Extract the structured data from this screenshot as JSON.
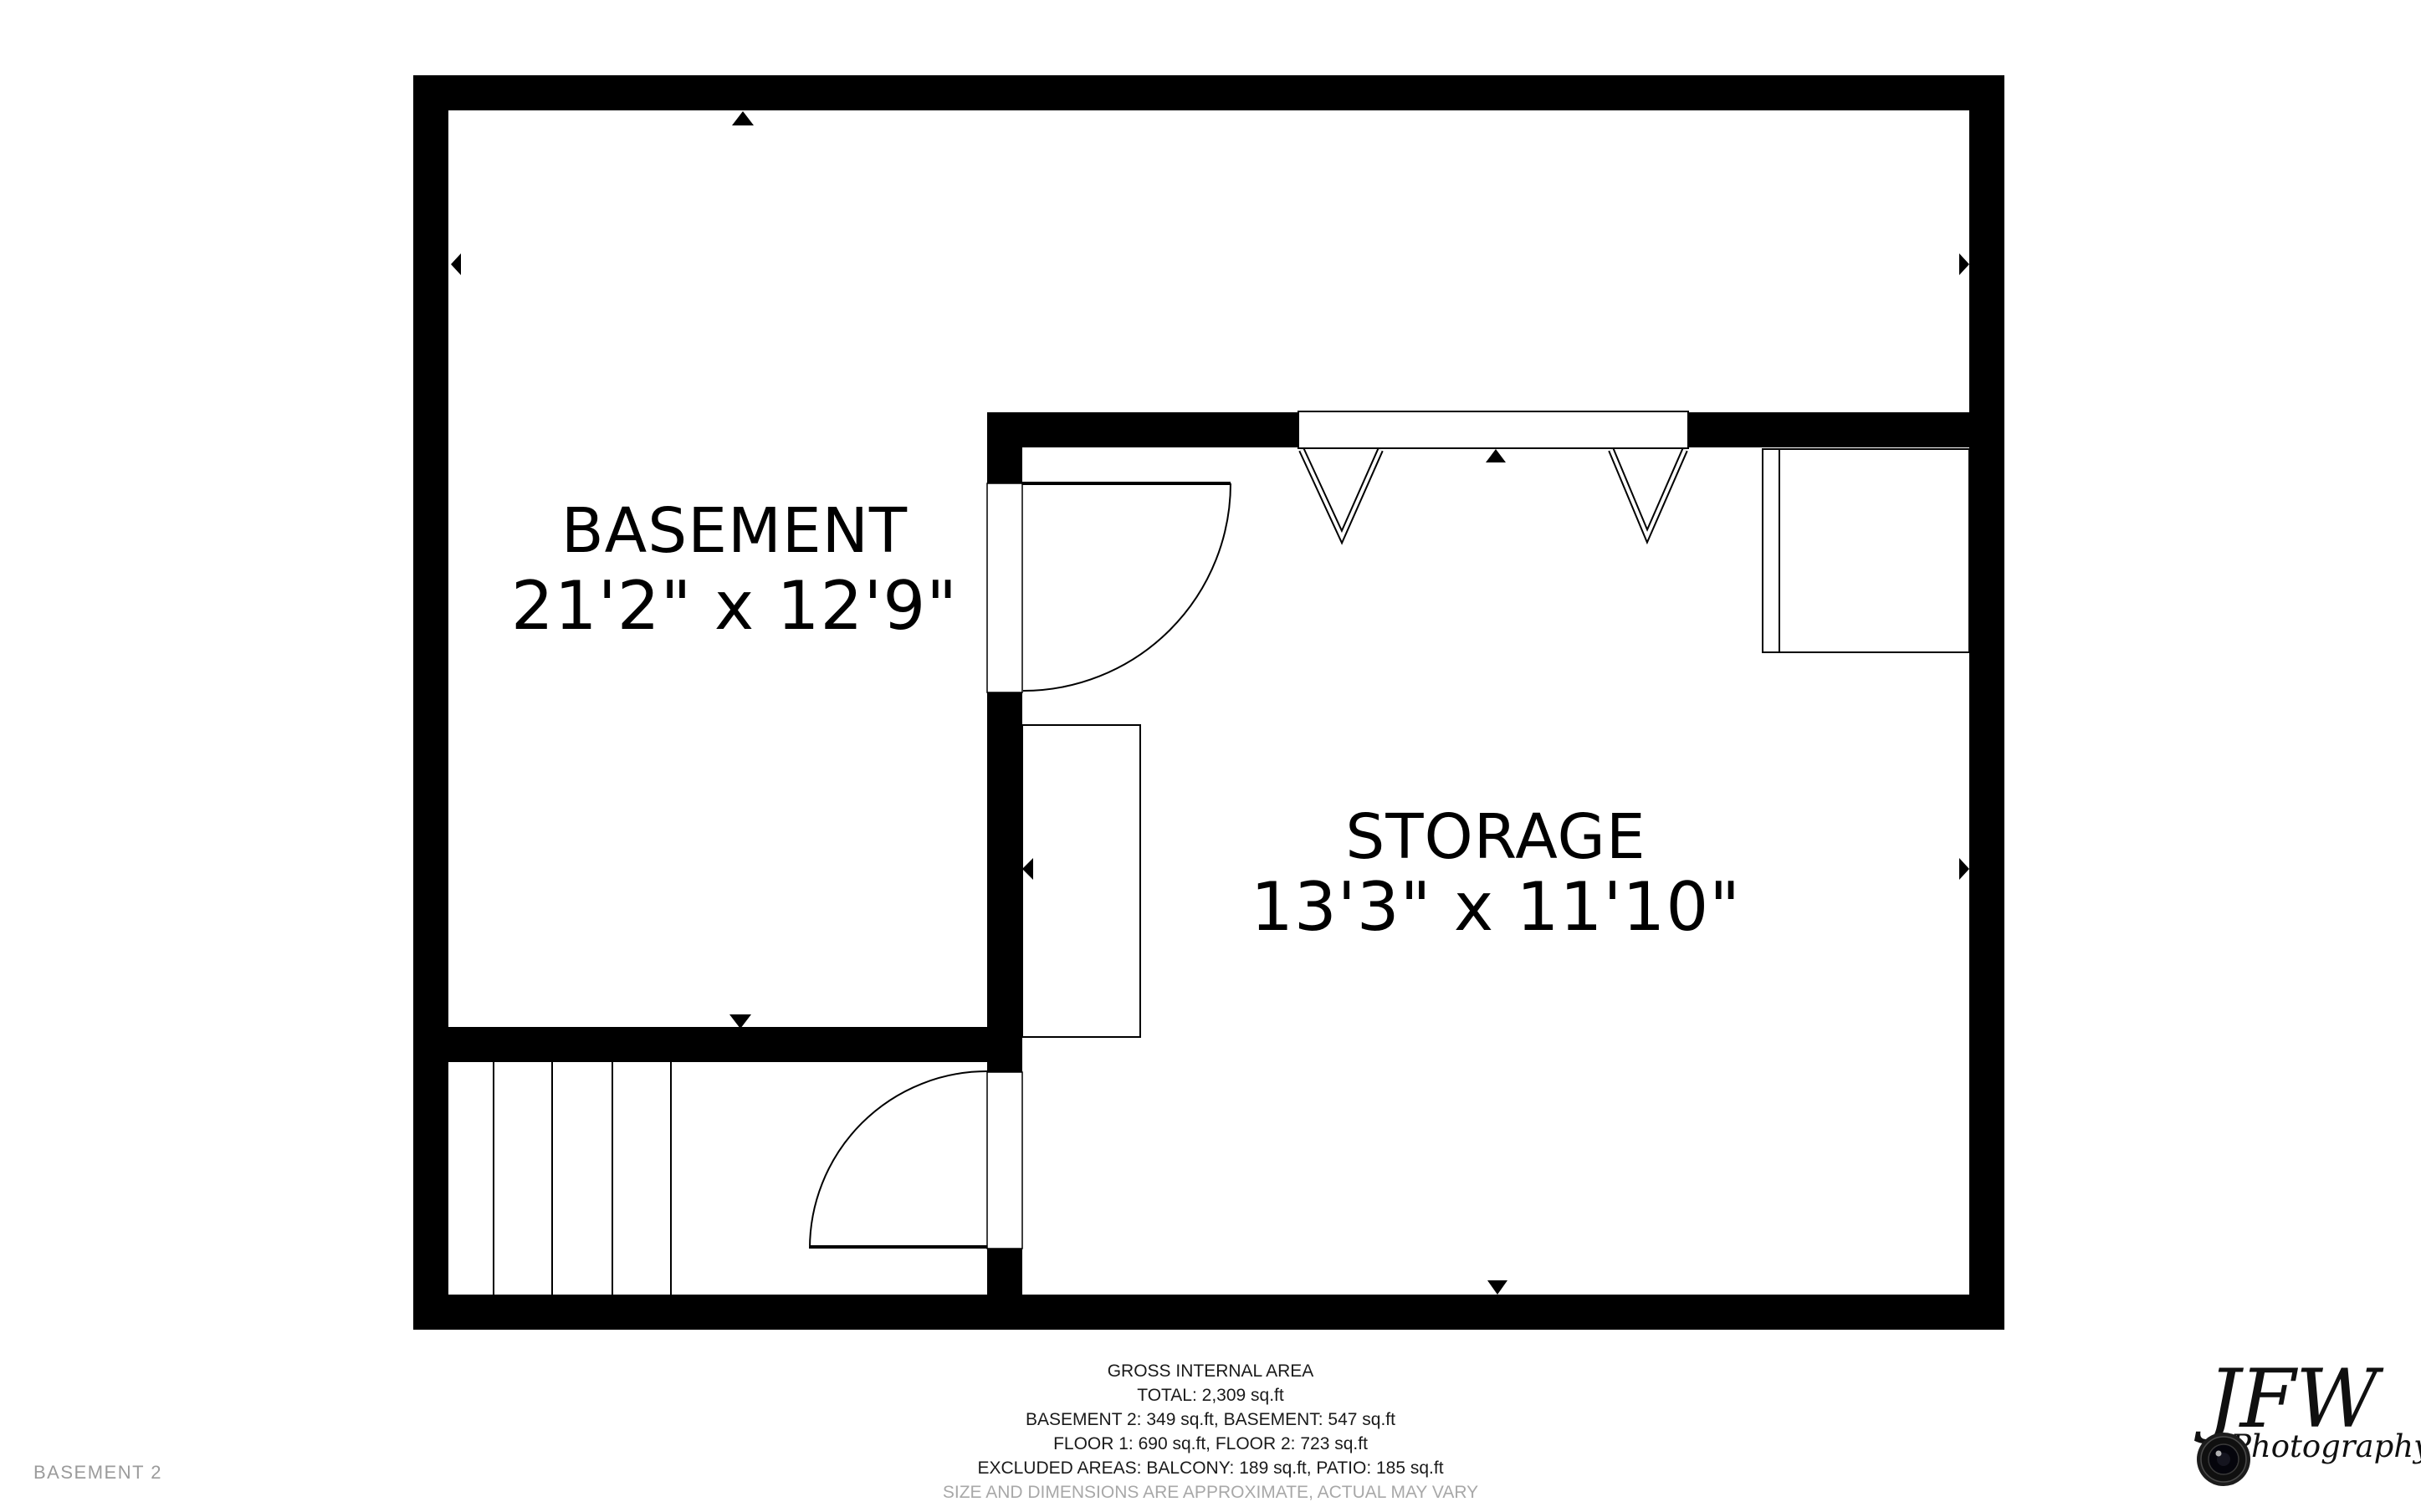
{
  "rooms": {
    "basement": {
      "name": "BASEMENT",
      "dimensions": "21'2\" x 12'9\""
    },
    "storage": {
      "name": "STORAGE",
      "dimensions": "13'3\" x 11'10\""
    }
  },
  "footer": {
    "title": "GROSS INTERNAL AREA",
    "total": "TOTAL: 2,309 sq.ft",
    "line_basements": "BASEMENT 2: 349 sq.ft, BASEMENT: 547 sq.ft",
    "line_floors": "FLOOR 1: 690 sq.ft, FLOOR 2: 723 sq.ft",
    "line_excluded": "EXCLUDED AREAS: BALCONY: 189 sq.ft, PATIO: 185 sq.ft",
    "disclaimer": "SIZE AND DIMENSIONS ARE APPROXIMATE, ACTUAL MAY VARY"
  },
  "page_label": "BASEMENT 2",
  "logo": {
    "initials": "JFW",
    "subtitle": "Photography"
  },
  "colors": {
    "wall": "#000000",
    "label_muted": "#9b9b9b",
    "footer_text": "#1a1a1a",
    "disclaimer_text": "#a8a8a8"
  }
}
